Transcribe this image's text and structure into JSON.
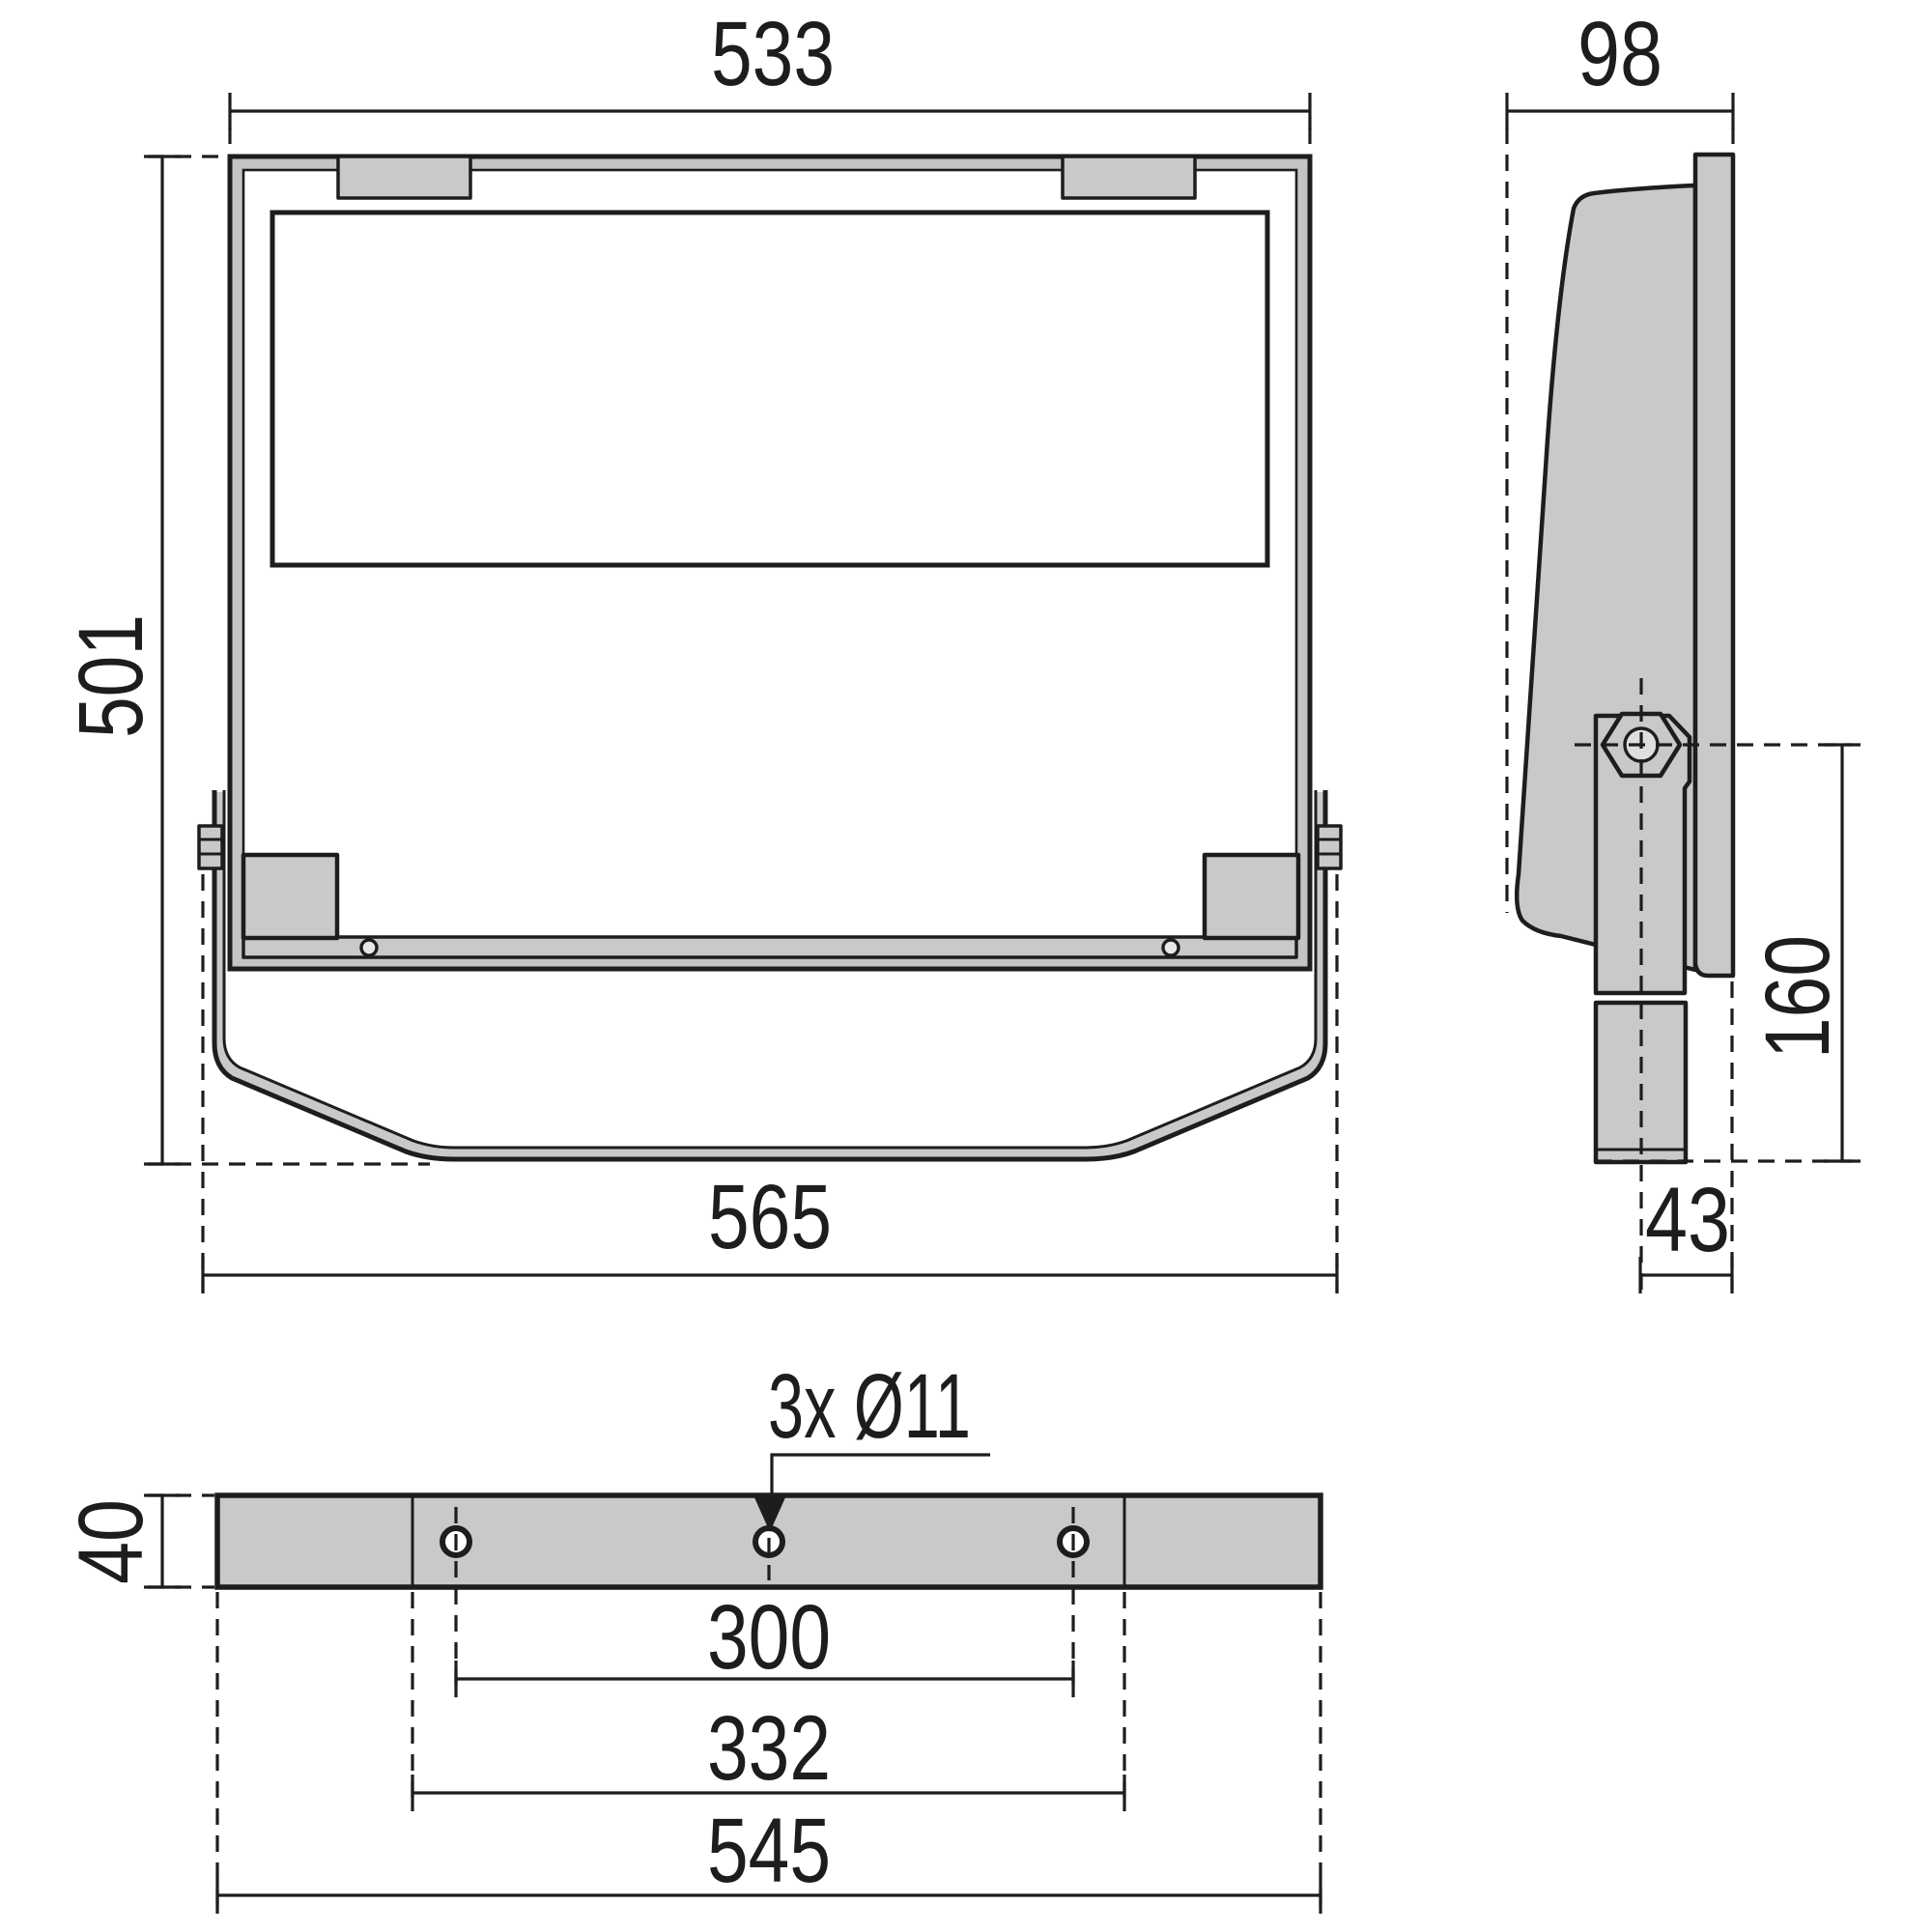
{
  "drawing": {
    "type": "technical-dimension-drawing",
    "units": "mm",
    "colors": {
      "line": "#1d1d1b",
      "part_fill": "#c9c9c9",
      "background": "#ffffff"
    },
    "front_view": {
      "width_top": "533",
      "height": "501",
      "width_bottom": "565"
    },
    "side_view": {
      "depth": "98",
      "pivot_to_bottom": "160",
      "pivot_offset": "43"
    },
    "bottom_view": {
      "bracket_height": "40",
      "hole_callout": "3x Ø11",
      "hole_spacing": "300",
      "inner_spacing": "332",
      "total_length": "545"
    }
  }
}
